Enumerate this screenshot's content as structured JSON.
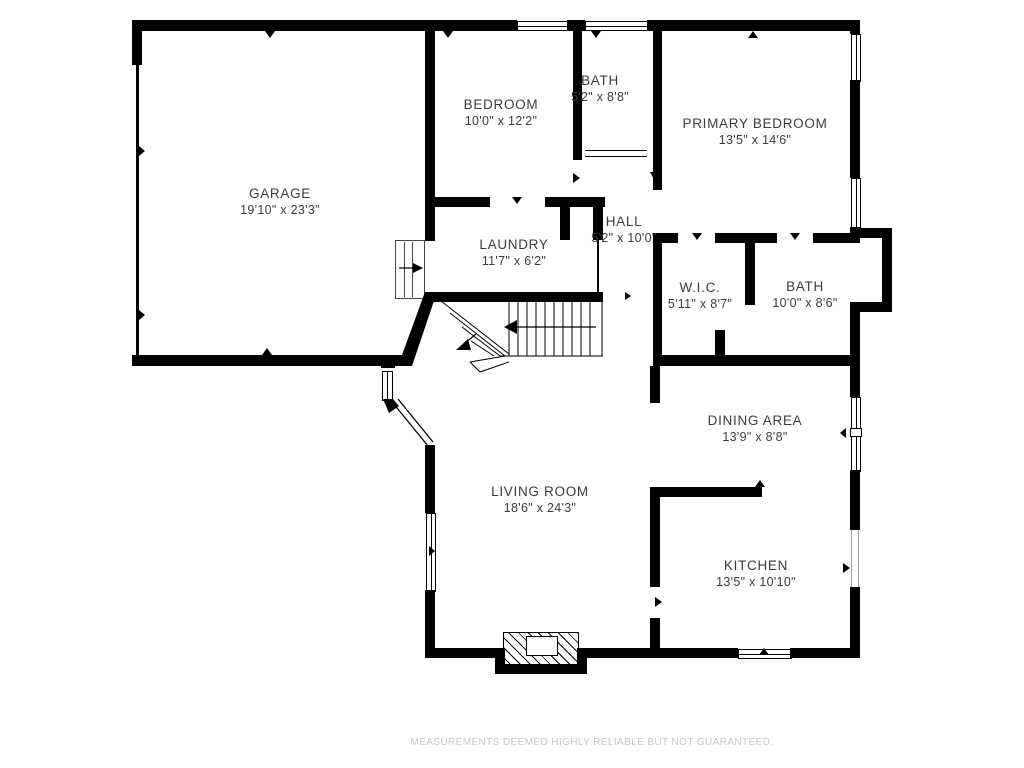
{
  "plan": {
    "rooms": [
      {
        "name": "GARAGE",
        "dims": "19'10\" x 23'3\""
      },
      {
        "name": "BEDROOM",
        "dims": "10'0\" x 12'2\""
      },
      {
        "name": "BATH",
        "dims": "5'2\" x 8'8\""
      },
      {
        "name": "PRIMARY BEDROOM",
        "dims": "13'5\" x 14'6\""
      },
      {
        "name": "HALL",
        "dims": "5'2\" x 10'0\""
      },
      {
        "name": "LAUNDRY",
        "dims": "11'7\" x 6'2\""
      },
      {
        "name": "W.I.C.",
        "dims": "5'11\" x 8'7\""
      },
      {
        "name": "BATH",
        "dims": "10'0\" x 8'6\""
      },
      {
        "name": "DINING AREA",
        "dims": "13'9\" x 8'8\""
      },
      {
        "name": "LIVING ROOM",
        "dims": "18'6\" x 24'3\""
      },
      {
        "name": "KITCHEN",
        "dims": "13'5\" x 10'10\""
      }
    ],
    "disclaimer": "MEASUREMENTS DEEMED HIGHLY RELIABLE BUT NOT GUARANTEED.",
    "colors": {
      "wall": "#000000",
      "label_text": "#3c3c3c",
      "disclaimer_text": "#c2c6cc",
      "background": "#ffffff"
    }
  }
}
